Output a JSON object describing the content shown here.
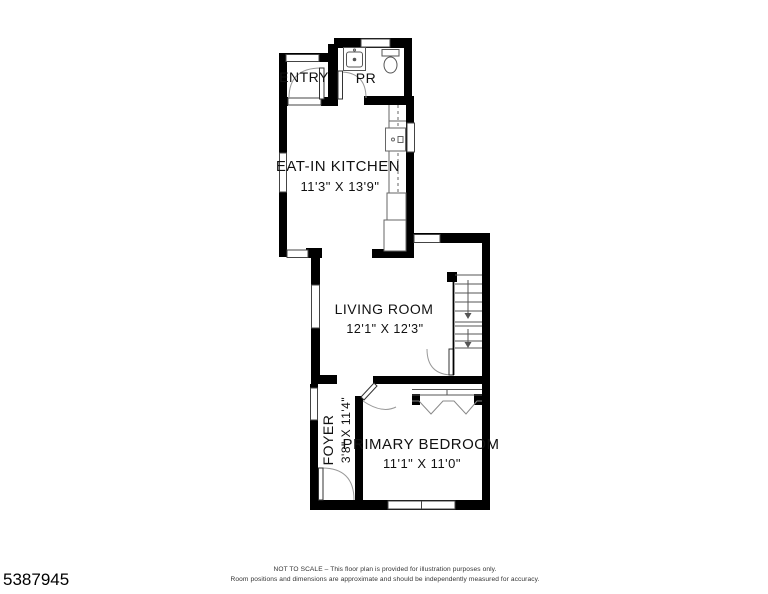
{
  "plan": {
    "rooms": {
      "entry": {
        "name": "ENTRY"
      },
      "powder_room": {
        "name": "PR"
      },
      "kitchen": {
        "name": "EAT-IN KITCHEN",
        "dims": "11'3\" X 13'9\""
      },
      "living_room": {
        "name": "LIVING ROOM",
        "dims": "12'1\" X 12'3\""
      },
      "foyer": {
        "name": "FOYER",
        "dims": "3'8\" X 11'4\""
      },
      "primary_bedroom": {
        "name": "PRIMARY BEDROOM",
        "dims": "11'1\" X 11'0\""
      }
    },
    "icons": [
      "sink-icon",
      "toilet-icon",
      "stove-icon",
      "stairs-down-arrow-icon",
      "closet-rod-icon"
    ]
  },
  "footer": {
    "disclaimer_line1": "NOT TO SCALE – This floor plan is provided for illustration purposes only.",
    "disclaimer_line2": "Room positions and dimensions are approximate and should be independently measured for accuracy.",
    "listing_id": "5387945"
  },
  "colors": {
    "background": "#ffffff",
    "wall": "#000000",
    "thin_line": "#555555",
    "arc_line": "#999999",
    "text": "#111111",
    "footer_text": "#333333"
  }
}
